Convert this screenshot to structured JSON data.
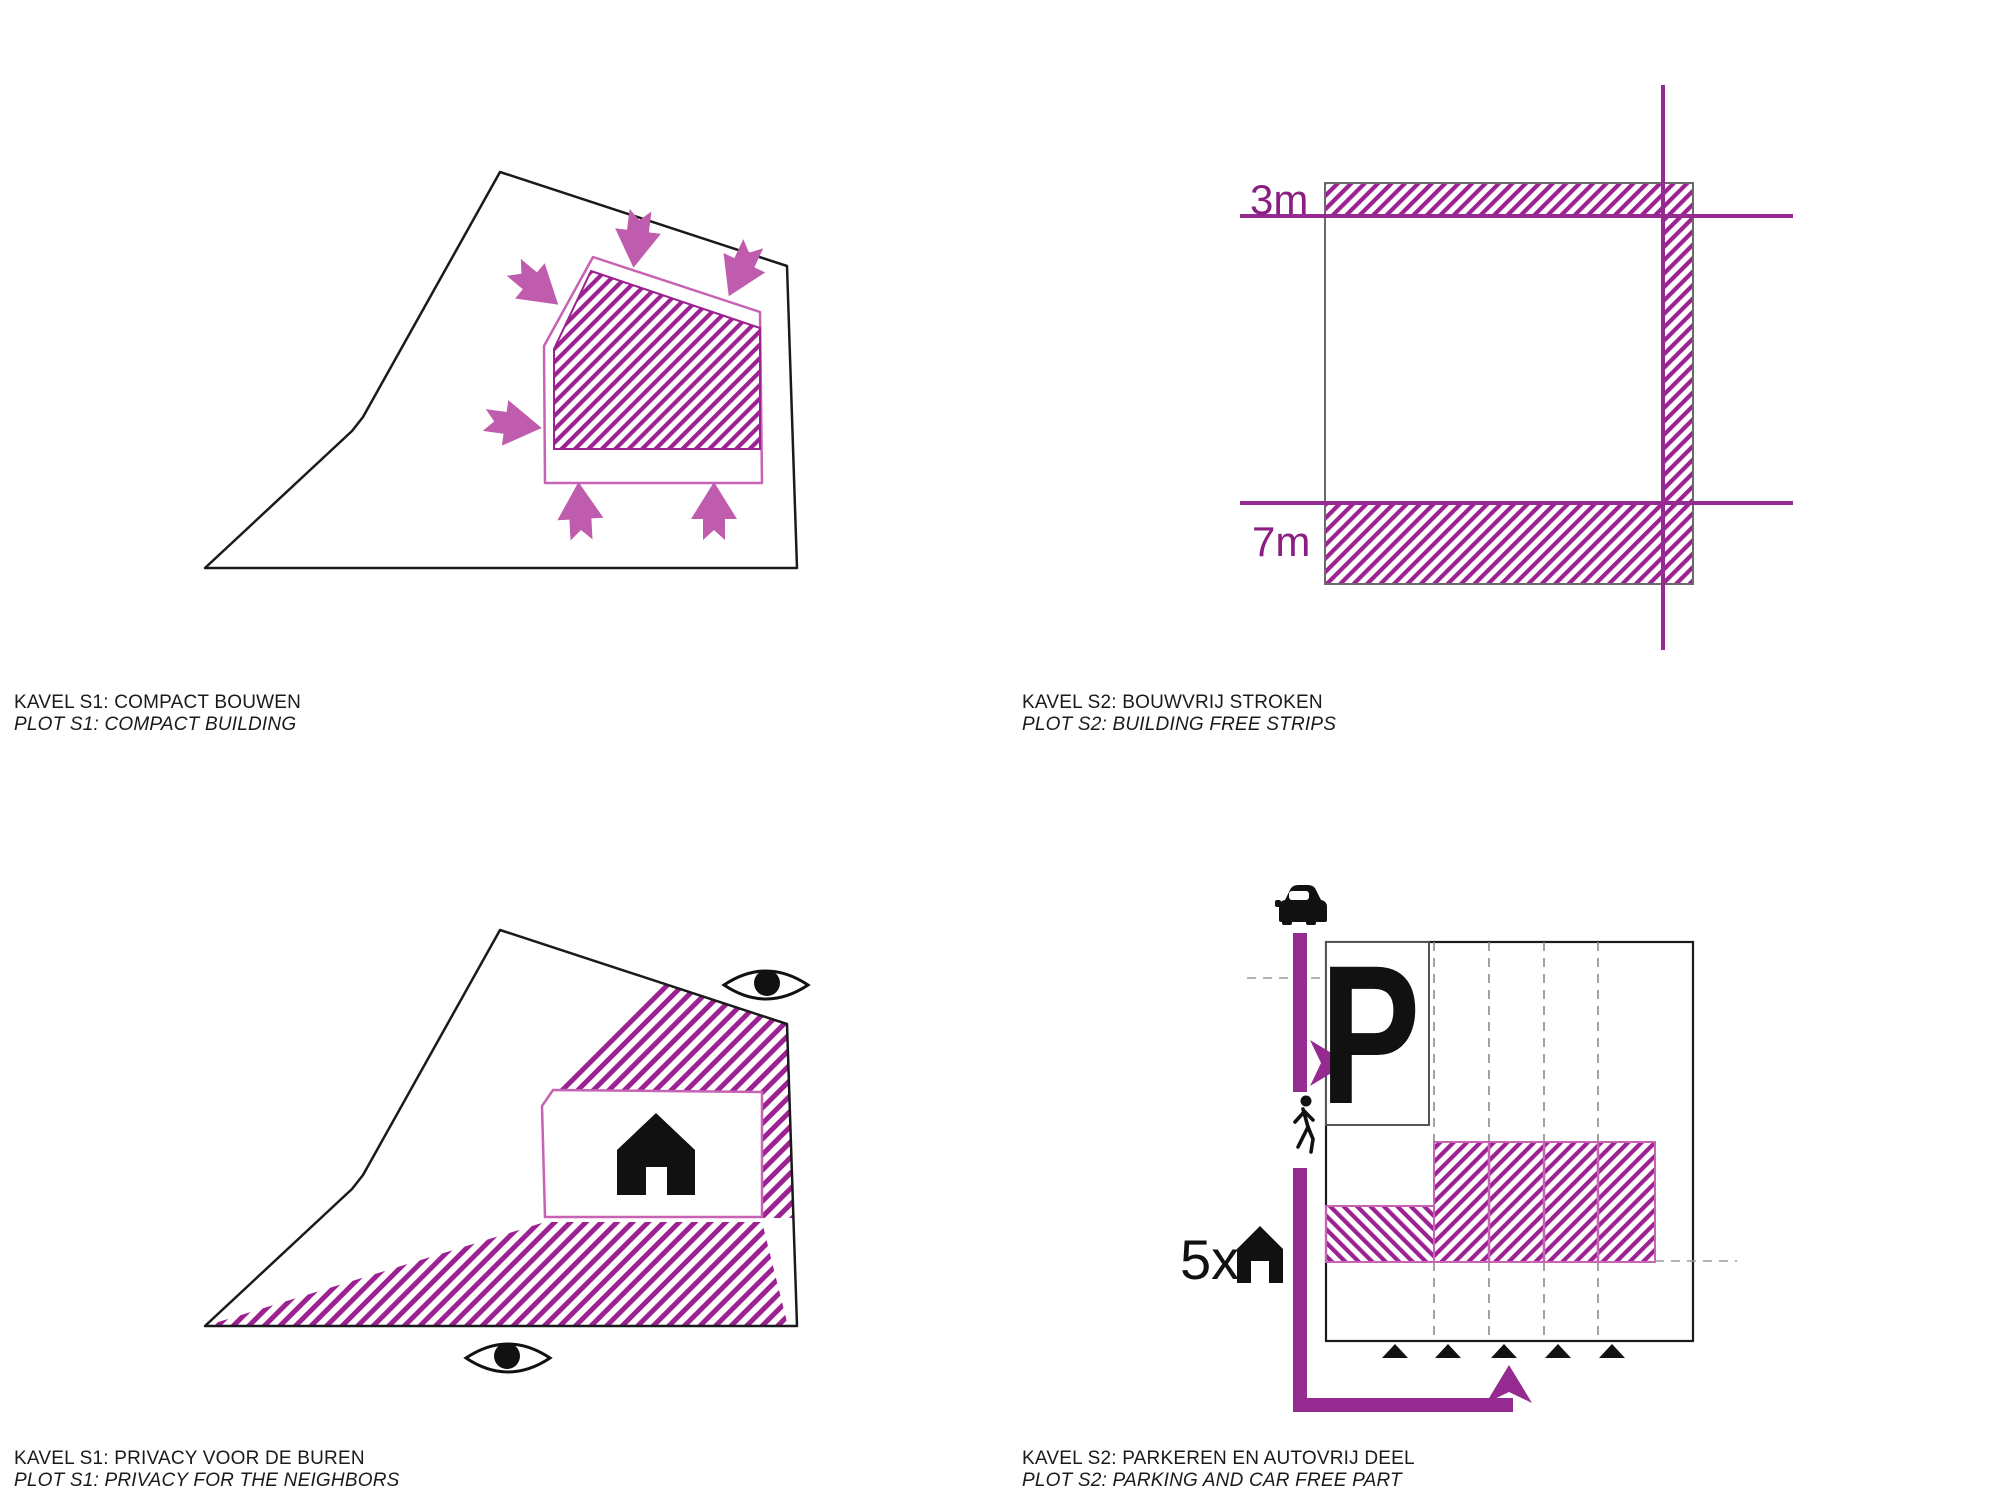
{
  "colors": {
    "hatch_magenta": "#9C2191",
    "outline_pink": "#C763B5",
    "arrow_orchid": "#C05CAE",
    "thick_purple": "#952A90",
    "dim_text_purple": "#8B1E82",
    "plot_black": "#1a1a1a",
    "square_gray": "#6a6a6a"
  },
  "panels": {
    "compact": {
      "title": "KAVEL S1: COMPACT BOUWEN",
      "subtitle": "PLOT S1: COMPACT BUILDING"
    },
    "strips": {
      "title": "KAVEL S2: BOUWVRIJ STROKEN",
      "subtitle": "PLOT S2: BUILDING FREE STRIPS",
      "top_offset_label": "3m",
      "bottom_offset_label": "7m"
    },
    "privacy": {
      "title": "KAVEL S1: PRIVACY VOOR DE BUREN",
      "subtitle": "PLOT S1: PRIVACY FOR THE NEIGHBORS"
    },
    "parking": {
      "title": "KAVEL S2: PARKEREN EN AUTOVRIJ DEEL",
      "subtitle": "PLOT S2: PARKING AND CAR FREE PART",
      "parking_label": "P",
      "houses_count_label": "5x"
    }
  }
}
